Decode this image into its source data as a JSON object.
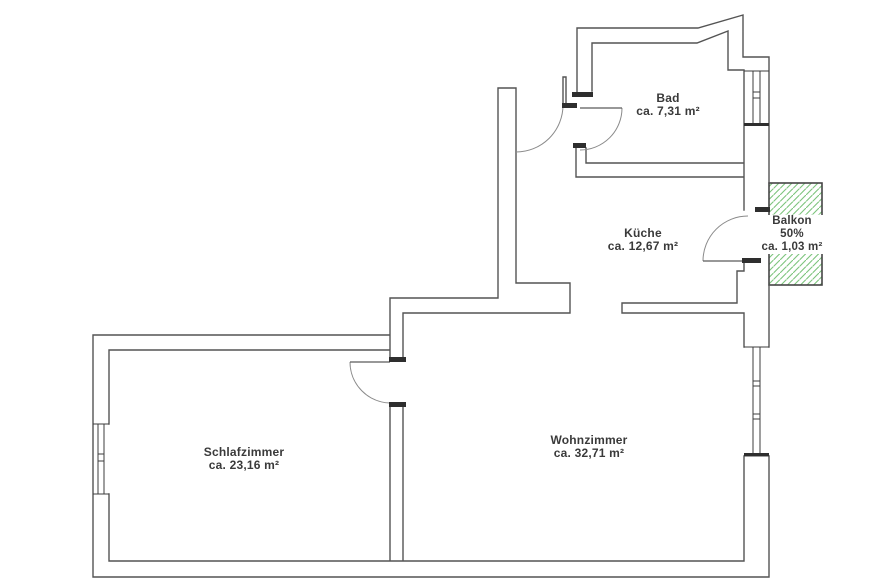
{
  "plan": {
    "rooms": {
      "bad": {
        "name": "Bad",
        "area": "ca. 7,31 m²"
      },
      "kueche": {
        "name": "Küche",
        "area": "ca. 12,67 m²"
      },
      "balkon": {
        "name": "Balkon",
        "share": "50%",
        "area": "ca. 1,03 m²"
      },
      "schlafzimmer": {
        "name": "Schlafzimmer",
        "area": "ca. 23,16 m²"
      },
      "wohnzimmer": {
        "name": "Wohnzimmer",
        "area": "ca. 32,71 m²"
      }
    },
    "colors": {
      "wall": "#545454",
      "door_arc": "#8a8a8a",
      "door_leaf": "#5a5a5a",
      "jamb": "#2e2e2e",
      "window": "#3c3c3c",
      "balcony_hatch": "#7cc47c",
      "balcony_border": "#454545",
      "text": "#3a3a3a",
      "background": "#ffffff"
    }
  }
}
